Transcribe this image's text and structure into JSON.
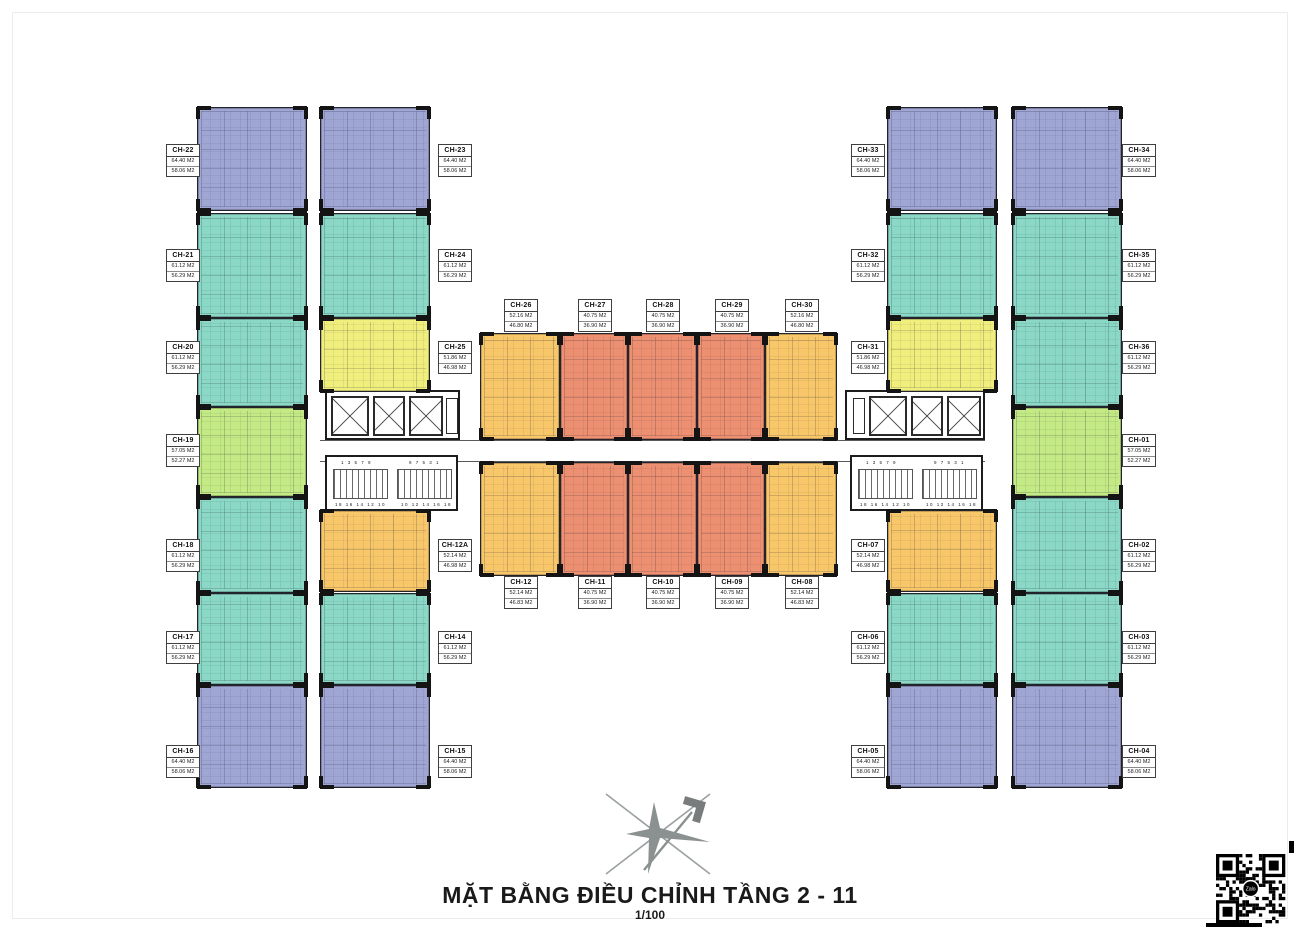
{
  "page": {
    "title": "MẶT BẰNG ĐIỀU CHỈNH TẦNG 2 - 11",
    "scale": "1/100"
  },
  "colors": {
    "blue": "#9fa6d3",
    "teal": "#8ad8c5",
    "green": "#c3ea85",
    "yellow": "#f0ef7d",
    "gold": "#f7c76a",
    "salmon": "#ed9071",
    "wall": "#141414"
  },
  "units": [
    {
      "id": "CH-22",
      "type": "blue",
      "area_top": "64.40 M2",
      "area_bottom": "58.06 M2"
    },
    {
      "id": "CH-21",
      "type": "teal",
      "area_top": "61.12 M2",
      "area_bottom": "56.29 M2"
    },
    {
      "id": "CH-20",
      "type": "teal",
      "area_top": "61.12 M2",
      "area_bottom": "56.29 M2"
    },
    {
      "id": "CH-19",
      "type": "green",
      "area_top": "57.05 M2",
      "area_bottom": "52.27 M2"
    },
    {
      "id": "CH-18",
      "type": "teal",
      "area_top": "61.12 M2",
      "area_bottom": "56.29 M2"
    },
    {
      "id": "CH-17",
      "type": "teal",
      "area_top": "61.12 M2",
      "area_bottom": "56.29 M2"
    },
    {
      "id": "CH-16",
      "type": "blue",
      "area_top": "64.40 M2",
      "area_bottom": "58.06 M2"
    },
    {
      "id": "CH-23",
      "type": "blue",
      "area_top": "64.40 M2",
      "area_bottom": "58.06 M2"
    },
    {
      "id": "CH-24",
      "type": "teal",
      "area_top": "61.12 M2",
      "area_bottom": "56.29 M2"
    },
    {
      "id": "CH-25",
      "type": "yellow",
      "area_top": "51.86 M2",
      "area_bottom": "46.98 M2"
    },
    {
      "id": "CH-12A",
      "type": "gold",
      "area_top": "52.14 M2",
      "area_bottom": "46.98 M2"
    },
    {
      "id": "CH-14",
      "type": "teal",
      "area_top": "61.12 M2",
      "area_bottom": "56.29 M2"
    },
    {
      "id": "CH-15",
      "type": "blue",
      "area_top": "64.40 M2",
      "area_bottom": "58.06 M2"
    },
    {
      "id": "CH-26",
      "type": "gold",
      "area_top": "52.16 M2",
      "area_bottom": "46.80 M2"
    },
    {
      "id": "CH-27",
      "type": "salmon",
      "area_top": "40.75 M2",
      "area_bottom": "36.90 M2"
    },
    {
      "id": "CH-28",
      "type": "salmon",
      "area_top": "40.75 M2",
      "area_bottom": "36.90 M2"
    },
    {
      "id": "CH-29",
      "type": "salmon",
      "area_top": "40.75 M2",
      "area_bottom": "36.90 M2"
    },
    {
      "id": "CH-30",
      "type": "gold",
      "area_top": "52.16 M2",
      "area_bottom": "46.80 M2"
    },
    {
      "id": "CH-12",
      "type": "gold",
      "area_top": "52.14 M2",
      "area_bottom": "46.83 M2"
    },
    {
      "id": "CH-11",
      "type": "salmon",
      "area_top": "40.75 M2",
      "area_bottom": "36.90 M2"
    },
    {
      "id": "CH-10",
      "type": "salmon",
      "area_top": "40.75 M2",
      "area_bottom": "36.90 M2"
    },
    {
      "id": "CH-09",
      "type": "salmon",
      "area_top": "40.75 M2",
      "area_bottom": "36.90 M2"
    },
    {
      "id": "CH-08",
      "type": "gold",
      "area_top": "52.14 M2",
      "area_bottom": "46.83 M2"
    },
    {
      "id": "CH-33",
      "type": "blue",
      "area_top": "64.40 M2",
      "area_bottom": "58.06 M2"
    },
    {
      "id": "CH-32",
      "type": "teal",
      "area_top": "61.12 M2",
      "area_bottom": "56.29 M2"
    },
    {
      "id": "CH-31",
      "type": "yellow",
      "area_top": "51.86 M2",
      "area_bottom": "46.98 M2"
    },
    {
      "id": "CH-07",
      "type": "gold",
      "area_top": "52.14 M2",
      "area_bottom": "46.98 M2"
    },
    {
      "id": "CH-06",
      "type": "teal",
      "area_top": "61.12 M2",
      "area_bottom": "56.29 M2"
    },
    {
      "id": "CH-05",
      "type": "blue",
      "area_top": "64.40 M2",
      "area_bottom": "58.06 M2"
    },
    {
      "id": "CH-34",
      "type": "blue",
      "area_top": "64.40 M2",
      "area_bottom": "58.06 M2"
    },
    {
      "id": "CH-35",
      "type": "teal",
      "area_top": "61.12 M2",
      "area_bottom": "56.29 M2"
    },
    {
      "id": "CH-36",
      "type": "teal",
      "area_top": "61.12 M2",
      "area_bottom": "56.29 M2"
    },
    {
      "id": "CH-01",
      "type": "green",
      "area_top": "57.05 M2",
      "area_bottom": "52.27 M2"
    },
    {
      "id": "CH-02",
      "type": "teal",
      "area_top": "61.12 M2",
      "area_bottom": "56.29 M2"
    },
    {
      "id": "CH-03",
      "type": "teal",
      "area_top": "61.12 M2",
      "area_bottom": "56.29 M2"
    },
    {
      "id": "CH-04",
      "type": "blue",
      "area_top": "64.40 M2",
      "area_bottom": "58.06 M2"
    }
  ],
  "core": {
    "stair_up": "1 3 5 7 9",
    "stair_up_rev": "9 7 5 3 1",
    "stair_down": "18 16 14 12 10",
    "stair_down_rev": "10 12 14 16 18"
  },
  "qr": {
    "logo": "Zalo"
  }
}
